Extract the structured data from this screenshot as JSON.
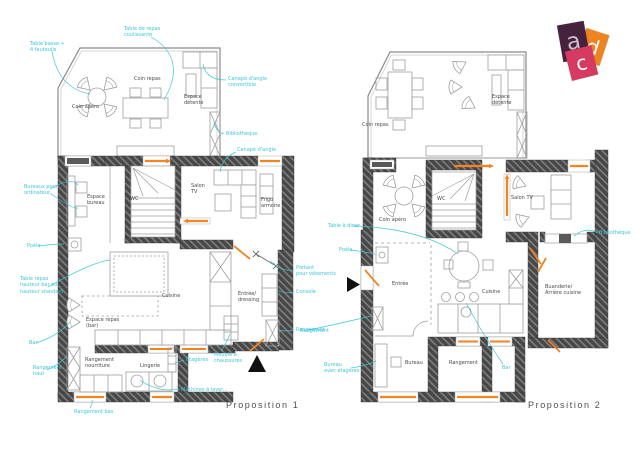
{
  "colors": {
    "annotation_cyan": "#3ec6d8",
    "wall_gray": "#474747",
    "accent_orange": "#f5831f",
    "logo_purple": "#46223f",
    "logo_orange": "#ee8322",
    "logo_pink": "#d63a60"
  },
  "logo": {
    "letters": [
      {
        "char": "a",
        "color": "#46223f"
      },
      {
        "char": "d",
        "color": "#ee8322"
      },
      {
        "char": "c",
        "color": "#d63a60"
      }
    ]
  },
  "plans": [
    {
      "name": "Proposition 1",
      "annotations": [
        {
          "text": "Table basse +\n4 fauteuils",
          "x": 30,
          "y": 41,
          "color": "cyan"
        },
        {
          "text": "Table de repas\ncoulissante",
          "x": 124,
          "y": 26,
          "color": "cyan"
        },
        {
          "text": "Canapé d'angle\nconvertible",
          "x": 228,
          "y": 76,
          "color": "cyan"
        },
        {
          "text": "Bibliothèque",
          "x": 226,
          "y": 131,
          "color": "cyan"
        },
        {
          "text": "Canapé d'angle",
          "x": 237,
          "y": 147,
          "color": "cyan"
        },
        {
          "text": "Bureaux pour\nordinateur",
          "x": 24,
          "y": 184,
          "color": "cyan"
        },
        {
          "text": "Poêle",
          "x": 27,
          "y": 243,
          "color": "cyan"
        },
        {
          "text": "Table repas\nhauteur bar ou\nhauteur standard",
          "x": 20,
          "y": 276,
          "color": "cyan"
        },
        {
          "text": "Bar",
          "x": 29,
          "y": 340,
          "color": "cyan"
        },
        {
          "text": "Rangement\nhaut",
          "x": 33,
          "y": 365,
          "color": "cyan"
        },
        {
          "text": "Rangement bas",
          "x": 74,
          "y": 409,
          "color": "cyan"
        },
        {
          "text": "Étagères",
          "x": 186,
          "y": 357,
          "color": "cyan"
        },
        {
          "text": "Meuble à\nchaussures",
          "x": 214,
          "y": 352,
          "color": "cyan"
        },
        {
          "text": "Machines à laver...",
          "x": 181,
          "y": 387,
          "color": "cyan"
        },
        {
          "text": "Portant\npour vêtements",
          "x": 296,
          "y": 265,
          "color": "cyan"
        },
        {
          "text": "Console",
          "x": 296,
          "y": 289,
          "color": "cyan"
        },
        {
          "text": "Rangement",
          "x": 296,
          "y": 327,
          "color": "cyan"
        },
        {
          "text": "Coin apéro",
          "x": 72,
          "y": 104,
          "color": "black"
        },
        {
          "text": "Coin repas",
          "x": 134,
          "y": 76,
          "color": "black"
        },
        {
          "text": "Espace\ndétente",
          "x": 184,
          "y": 94,
          "color": "black"
        },
        {
          "text": "Espace\nbureau",
          "x": 87,
          "y": 194,
          "color": "black"
        },
        {
          "text": "WC",
          "x": 130,
          "y": 196,
          "color": "black"
        },
        {
          "text": "Salon\nTV",
          "x": 191,
          "y": 183,
          "color": "black"
        },
        {
          "text": "Frigo\narmoire",
          "x": 261,
          "y": 197,
          "color": "black"
        },
        {
          "text": "Espace repas\n(bar)",
          "x": 86,
          "y": 317,
          "color": "black"
        },
        {
          "text": "Rangement\nnourriture",
          "x": 85,
          "y": 357,
          "color": "black"
        },
        {
          "text": "Cuisine",
          "x": 162,
          "y": 293,
          "color": "black"
        },
        {
          "text": "Entrée/\ndressing",
          "x": 238,
          "y": 291,
          "color": "black"
        },
        {
          "text": "Lingerie",
          "x": 140,
          "y": 363,
          "color": "black"
        }
      ]
    },
    {
      "name": "Proposition 2",
      "annotations": [
        {
          "text": "Table à diner",
          "x": 328,
          "y": 223,
          "color": "cyan"
        },
        {
          "text": "Poêle",
          "x": 339,
          "y": 247,
          "color": "cyan"
        },
        {
          "text": "Bibliothèque",
          "x": 599,
          "y": 230,
          "color": "cyan"
        },
        {
          "text": "Rangement",
          "x": 300,
          "y": 328,
          "color": "cyan"
        },
        {
          "text": "Bureau\navec étagères",
          "x": 324,
          "y": 362,
          "color": "cyan"
        },
        {
          "text": "Bar",
          "x": 502,
          "y": 365,
          "color": "cyan"
        },
        {
          "text": "Coin repas",
          "x": 362,
          "y": 122,
          "color": "black"
        },
        {
          "text": "Espace\ndétente",
          "x": 492,
          "y": 94,
          "color": "black"
        },
        {
          "text": "Coin apéro",
          "x": 379,
          "y": 217,
          "color": "black"
        },
        {
          "text": "WC",
          "x": 437,
          "y": 196,
          "color": "black"
        },
        {
          "text": "Salon TV",
          "x": 511,
          "y": 195,
          "color": "black"
        },
        {
          "text": "Entrée",
          "x": 392,
          "y": 281,
          "color": "black"
        },
        {
          "text": "Cuisine",
          "x": 482,
          "y": 289,
          "color": "black"
        },
        {
          "text": "Buanderie/\nArrière cuisine",
          "x": 545,
          "y": 284,
          "color": "black"
        },
        {
          "text": "Bureau",
          "x": 405,
          "y": 360,
          "color": "black"
        },
        {
          "text": "Rangement",
          "x": 449,
          "y": 360,
          "color": "black"
        }
      ]
    }
  ]
}
